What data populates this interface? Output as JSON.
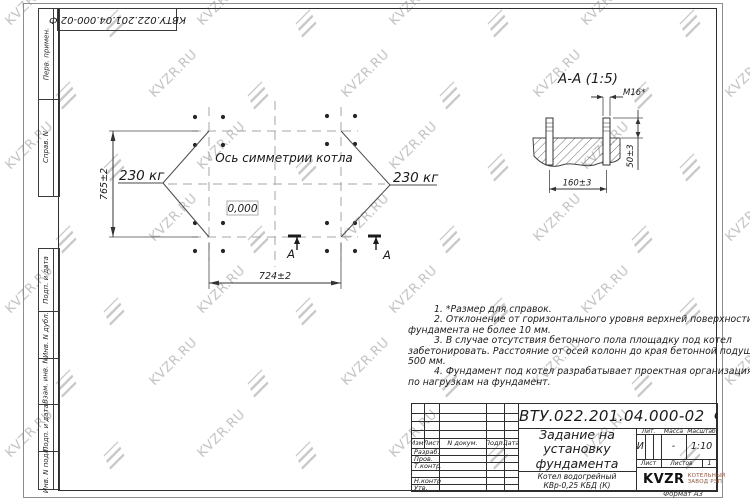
{
  "watermark": {
    "text": "KVZR.RU"
  },
  "top_stamp": {
    "text": "КВТУ.022.201.04.000-02 Ф"
  },
  "side_strip": {
    "labels": [
      "Перв. примен.",
      "Справ. N",
      "Подп. и дата",
      "Инв. N дубл.",
      "Взам. инв. N",
      "Подп. и дата",
      "Инв. N подл."
    ]
  },
  "plan": {
    "symmetry_label": "Ось симметрии котла",
    "elevation_mark": "0,000",
    "load_left": "230 кг",
    "load_right": "230 кг",
    "dim_vertical": "765±2",
    "dim_horizontal": "724±2",
    "section_letter_left": "А",
    "section_letter_right": "А"
  },
  "section_view": {
    "title": "А-А (1:5)",
    "thread_label": "М16*",
    "dim_protrusion": "50±3",
    "dim_spacing": "160±3"
  },
  "notes": {
    "lines": [
      "1. *Размер для справок.",
      "2. Отклонение от горизонтального уровня верхней поверхности",
      "фундамента не более 10 мм.",
      "3. В случае отсутствия бетонного пола площадку под котел",
      "забетонировать. Расстояние от осей колонн до края бетонной подушки",
      "500 мм.",
      "4. Фундамент под котел разрабатывает проектная организация",
      "по нагрузкам на фундамент."
    ]
  },
  "title_block": {
    "doc_number": "КВТУ.022.201.04.000-02 Ф",
    "title_lines": [
      "Задание на",
      "установку",
      "фундамента"
    ],
    "product_lines": [
      "Котел водогрейный",
      "КВр-0,25 КБД (К)"
    ],
    "header_cols": [
      "Изм.",
      "Лист",
      "N докум.",
      "Подп.",
      "Дата"
    ],
    "row_labels": [
      "Разраб.",
      "Пров.",
      "Т.контр.",
      "",
      "Н.контр.",
      "Утв."
    ],
    "lit_label": "Лит.",
    "mass_label": "Масса",
    "scale_label": "Масштаб",
    "lit_value": "И",
    "mass_value": "-",
    "scale_value": "1:10",
    "sheet_label": "Лист",
    "sheets_label": "Листов",
    "sheets_value": "1",
    "brand_name": "KVZR",
    "brand_sub_lines": [
      "КОТЕЛЬНЫЙ",
      "ЗАВОД РЭП"
    ],
    "format_label": "Формат А3"
  },
  "colors": {
    "line_dark": "#3a3a3a",
    "line_dashed": "#a6a6a6",
    "watermark": "#c3c3c3",
    "brand_sub": "#8a5a47"
  }
}
